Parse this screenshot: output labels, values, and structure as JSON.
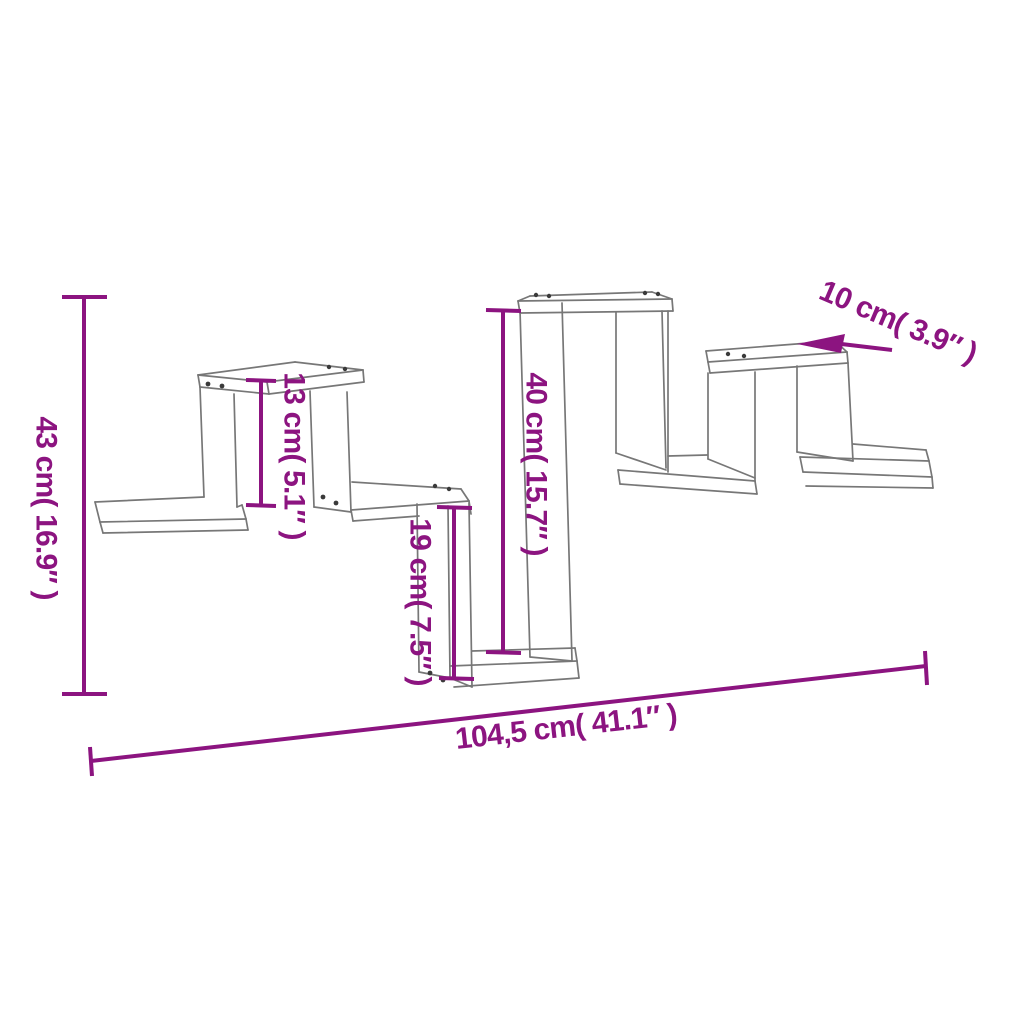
{
  "diagram": {
    "background_color": "#ffffff",
    "drawing_color": "#777777",
    "dimension_color": "#8c1480",
    "labels": {
      "total_height": "43 cm( 16.9″ )",
      "small_box_height": "13 cm( 5.1″ )",
      "tall_box_height": "40 cm( 15.7″ )",
      "lower_box_height": "19 cm( 7.5″ )",
      "depth": "10 cm( 3.9″ )",
      "total_width": "104,5 cm( 41.1″ )"
    }
  }
}
